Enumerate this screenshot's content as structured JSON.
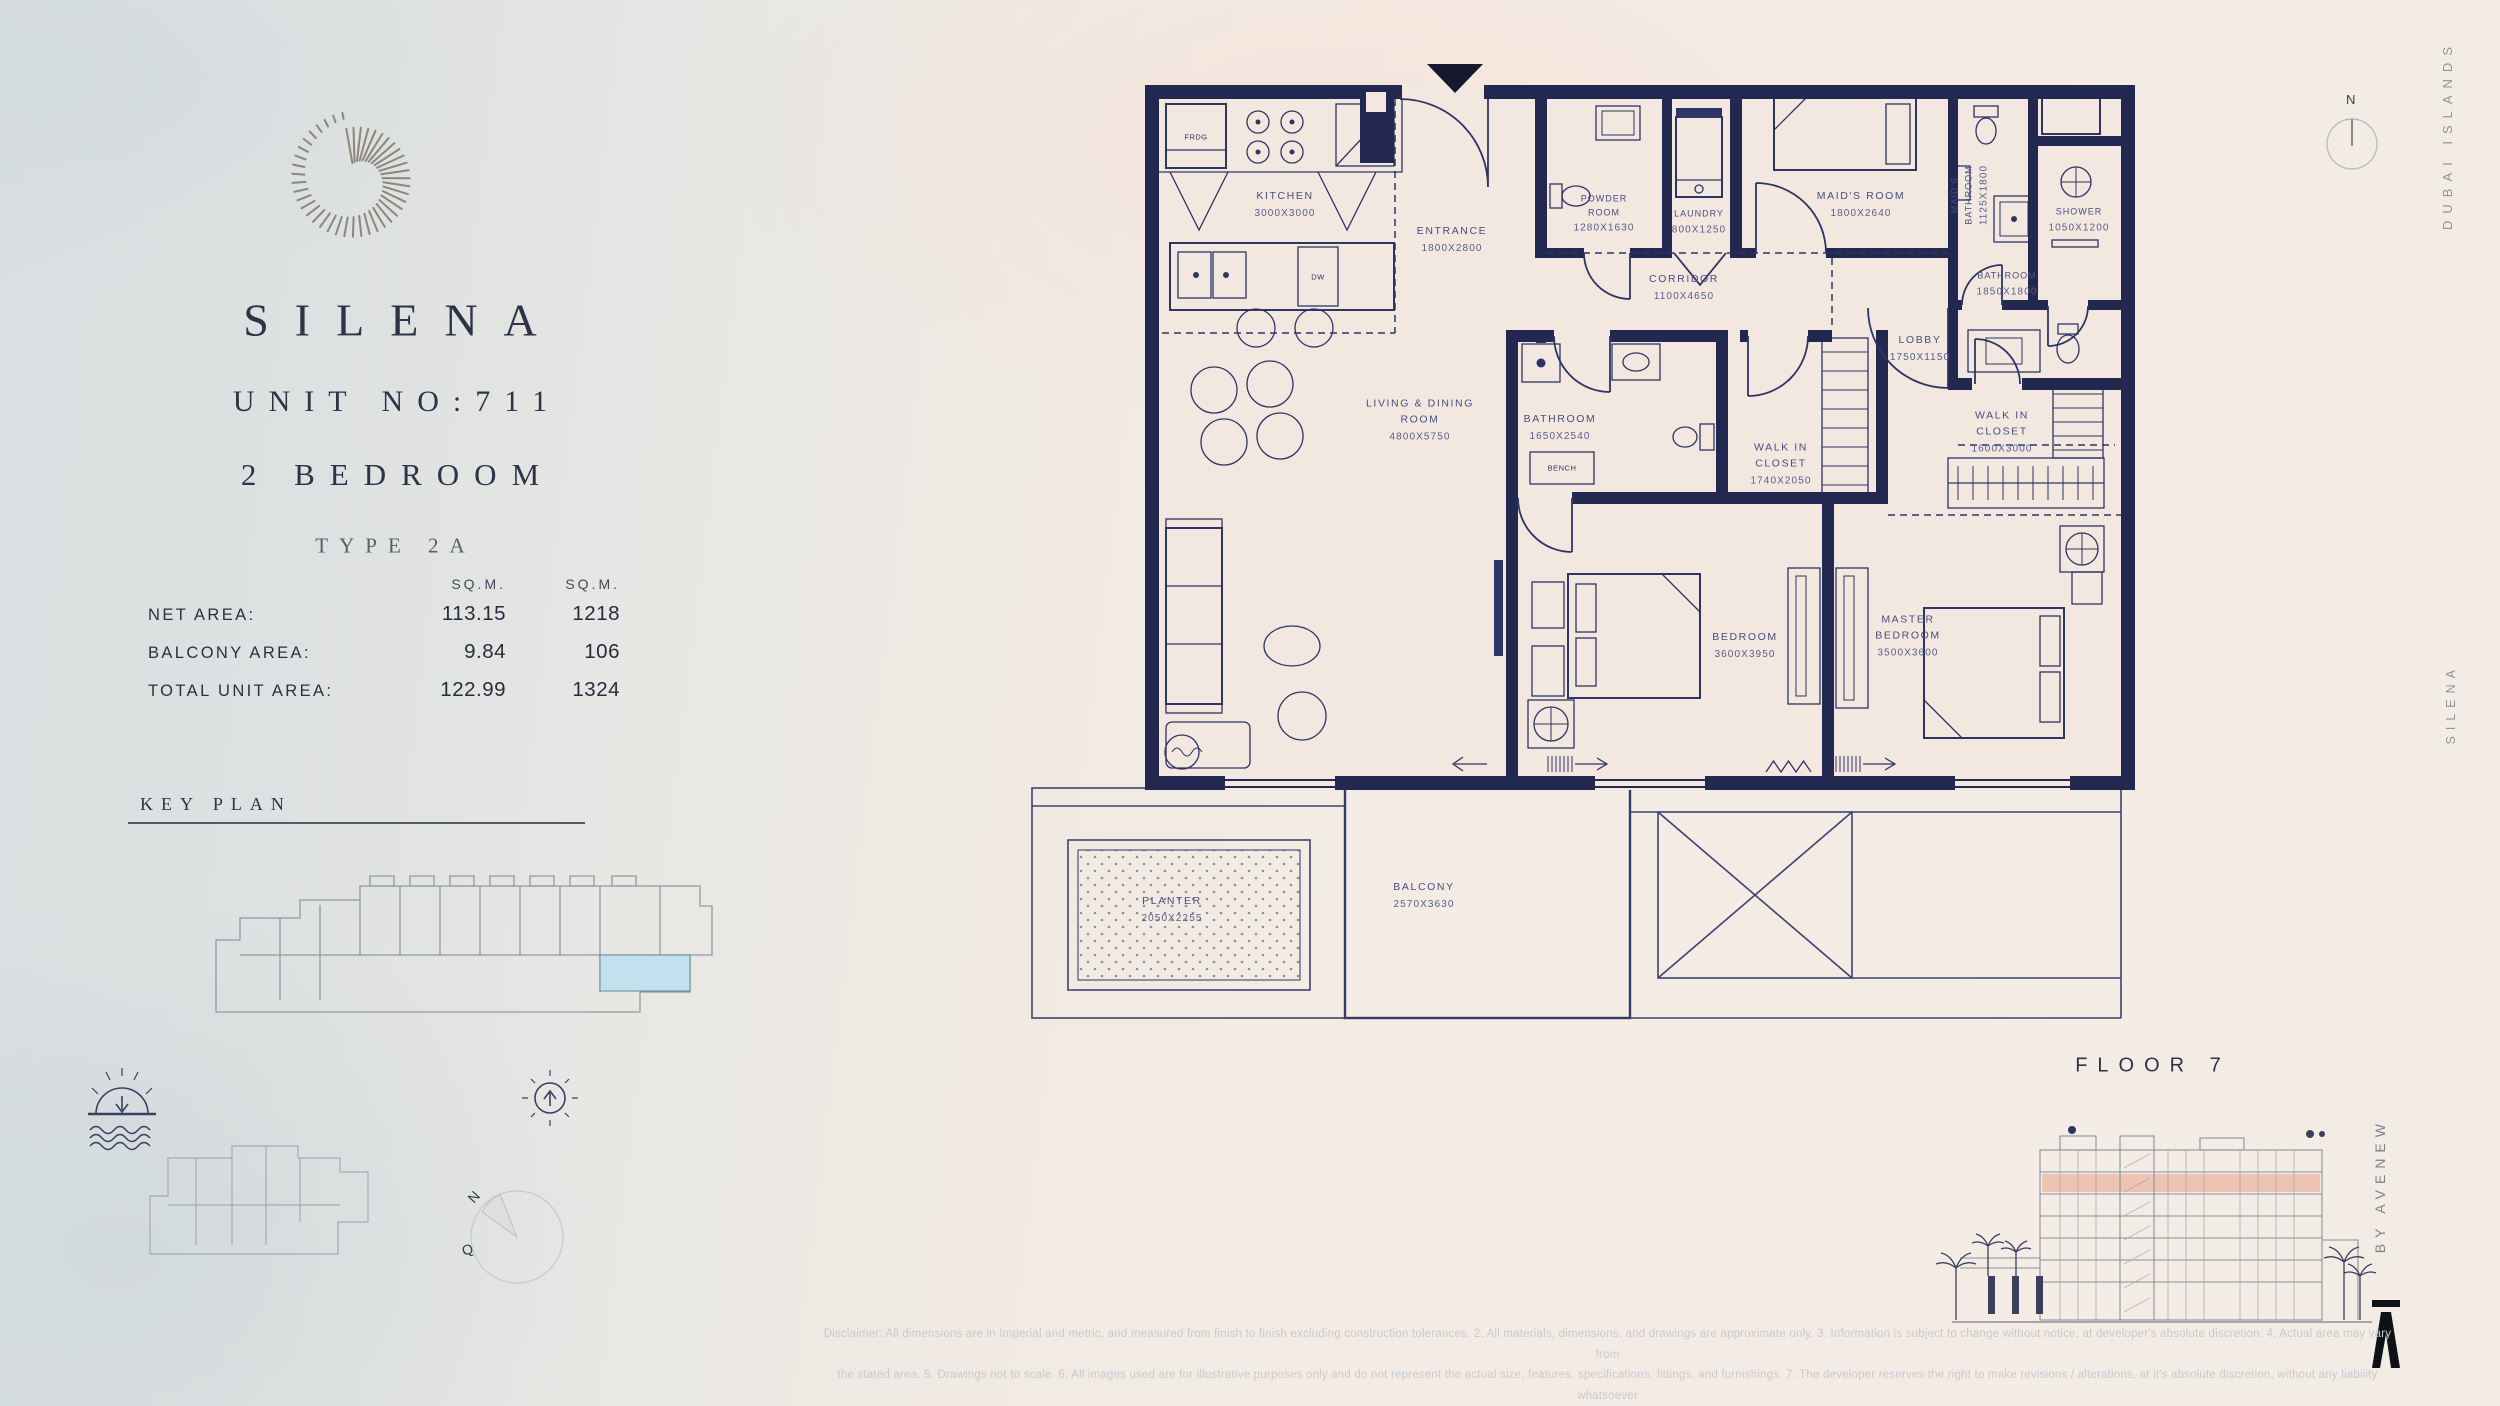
{
  "left_panel": {
    "project": "SILENA",
    "unit_no": "UNIT NO:711",
    "bedrooms": "2 BEDROOM",
    "type": "TYPE 2A",
    "area_table": {
      "col_headers": [
        "SQ.M.",
        "SQ.M."
      ],
      "rows": [
        {
          "label": "NET AREA:",
          "sqm": "113.15",
          "sqft": "1218"
        },
        {
          "label": "BALCONY AREA:",
          "sqm": "9.84",
          "sqft": "106"
        },
        {
          "label": "TOTAL UNIT AREA:",
          "sqm": "122.99",
          "sqft": "1324"
        }
      ]
    },
    "key_plan_title": "KEY PLAN"
  },
  "plan": {
    "rooms": [
      {
        "name": "KITCHEN",
        "dims": "3000X3000"
      },
      {
        "name": "ENTRANCE",
        "dims": "1800X2800"
      },
      {
        "name": "POWDER ROOM",
        "dims": "1280X1630"
      },
      {
        "name": "LAUNDRY",
        "dims": "800X1250"
      },
      {
        "name": "MAID'S ROOM",
        "dims": "1800X2640"
      },
      {
        "name": "MAID'S BATHROOM",
        "dims": "1125X1800"
      },
      {
        "name": "SHOWER",
        "dims": "1050X1200"
      },
      {
        "name": "CORRIDOR",
        "dims": "1100X4650"
      },
      {
        "name": "BATHROOM",
        "dims": "1850X1800"
      },
      {
        "name": "LOBBY",
        "dims": "1750X1150"
      },
      {
        "name": "BATHROOM",
        "dims": "1650X2540"
      },
      {
        "name": "WALK IN CLOSET",
        "dims": "1740X2050"
      },
      {
        "name": "WALK IN CLOSET",
        "dims": "1600X3000"
      },
      {
        "name": "LIVING & DINING ROOM",
        "dims": "4800X5750"
      },
      {
        "name": "BEDROOM",
        "dims": "3600X3950"
      },
      {
        "name": "MASTER BEDROOM",
        "dims": "3500X3600"
      },
      {
        "name": "BALCONY",
        "dims": "2570X3630"
      },
      {
        "name": "PLANTER",
        "dims": "2050X2255"
      }
    ],
    "small_labels": {
      "fridge": "FRDG",
      "dishwasher": "DW",
      "bench": "BENCH"
    }
  },
  "right_panel": {
    "location_vertical": "DUBAI ISLANDS",
    "project_vertical": "SILENA",
    "developer_vertical": "BY AVENEW",
    "floor_label": "FLOOR 7",
    "north_label": "N"
  },
  "compass": {
    "north": "N",
    "west": "Q"
  },
  "footer": {
    "disclaimer_line1": "Disclaimer: All dimensions are in Imperial and metric, and measured from finish to finish excluding construction tolerances. 2. All materials, dimensions, and drawings are approximate only. 3. Information is subject to change without notice, at developer's absolute discretion. 4. Actual area may vary from",
    "disclaimer_line2": "the stated area. 5. Drawings not to scale. 6. All images used are for illustrative purposes only and do not represent the actual size, features, specifications, fittings, and furnishings. 7. The developer reserves the right to make revisions / alterations, at it's absolute discretion, without any liability whatsoever"
  },
  "colors": {
    "wall_navy": "#232850",
    "line_navy": "#2e3464",
    "cream": "#f2e8e0",
    "salmon": "#ecc0ad",
    "keyplan_highlight": "#c2e1ef"
  }
}
